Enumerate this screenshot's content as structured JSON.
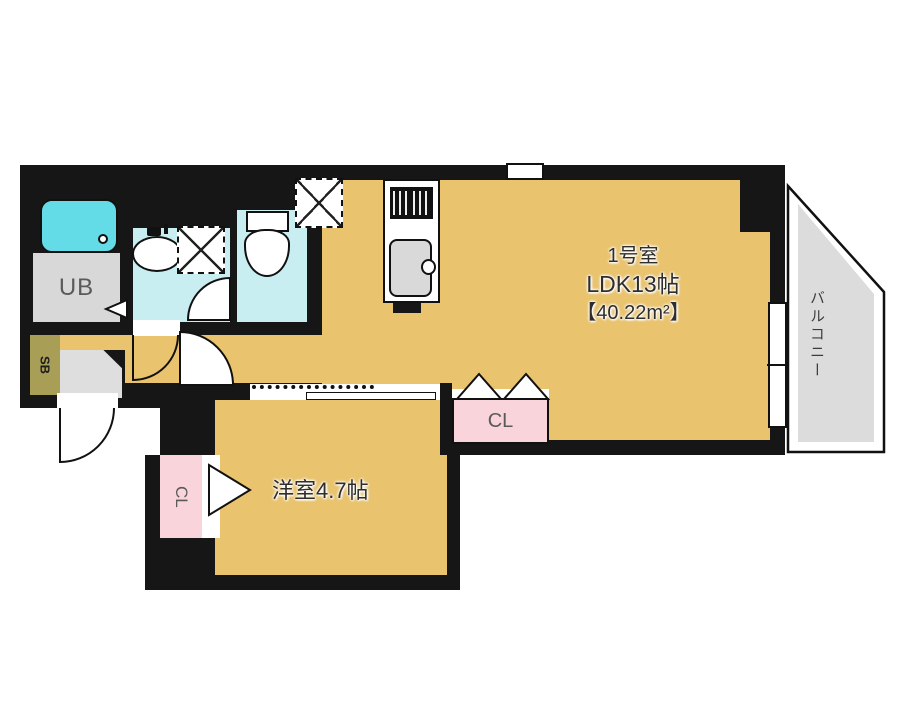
{
  "labels": {
    "room_number": "1号室",
    "ldk": "LDK13帖",
    "area": "【40.22m²】",
    "west_room": "洋室4.7帖",
    "balcony": "バルコニー",
    "unit_bath": "UB",
    "shoe_box": "SB",
    "closet": "CL",
    "closet_west": "CL"
  },
  "colors": {
    "floor": "#E9C36E",
    "wall": "#161616",
    "water": "#C8EEF2",
    "tub": "#63DCE8",
    "gray": "#D8D8D8",
    "balcony": "#DCDCDC",
    "pink": "#F9D4DA",
    "olive": "#A89E55",
    "label-dark": "#2E2E2E",
    "label-gray": "#5A5A5A"
  }
}
